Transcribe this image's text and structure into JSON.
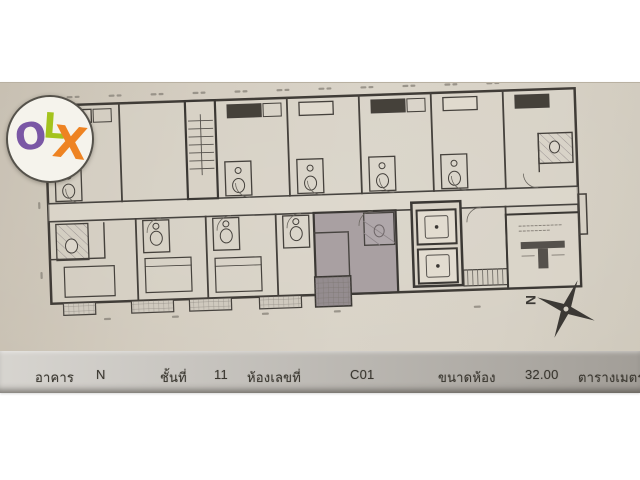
{
  "document": {
    "type": "condominium floor plan photo",
    "highlighted_unit": "C01"
  },
  "logo": {
    "name": "OLX",
    "letters": [
      {
        "char": "O",
        "color": "#7a57a5"
      },
      {
        "char": "L",
        "color": "#a4c31d"
      },
      {
        "char": "X",
        "color": "#ee8322"
      }
    ]
  },
  "compass": {
    "label": "N"
  },
  "footer": {
    "fields": [
      {
        "label": "อาคาร",
        "value": "N"
      },
      {
        "label": "ชั้นที่",
        "value": "11"
      },
      {
        "label": "ห้องเลขที่",
        "value": "C01"
      },
      {
        "label": "ขนาดห้อง",
        "value": "32.00",
        "unit": "ตารางเมตร"
      }
    ]
  },
  "colors": {
    "paper": "#d2cbbe",
    "wall_ink": "#403c37",
    "highlight_unit_fill": "#a69da0",
    "footer_band_right": "#a09c96",
    "white_margin": "#ffffff"
  }
}
